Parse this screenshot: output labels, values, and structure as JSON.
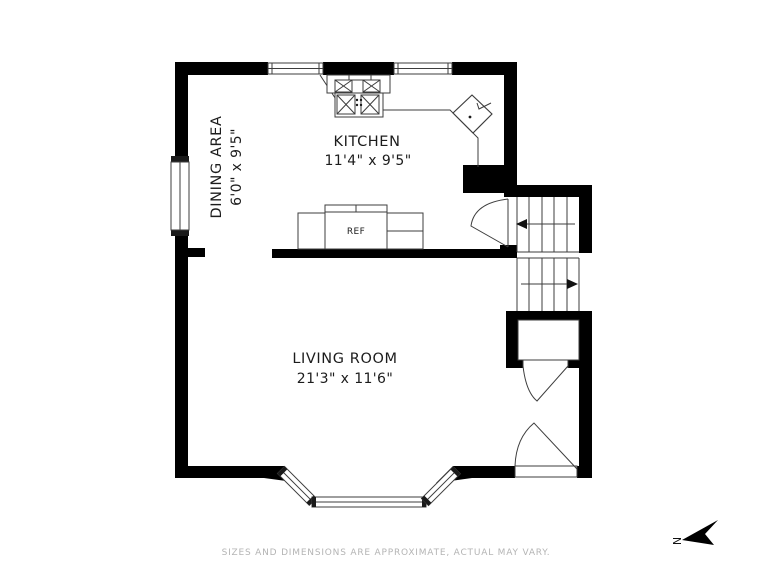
{
  "title": "Floor plan",
  "rooms": {
    "dining": {
      "name": "DINING AREA",
      "dims": "6'0\" x 9'5\""
    },
    "kitchen": {
      "name": "KITCHEN",
      "dims": "11'4\" x 9'5\""
    },
    "living": {
      "name": "LIVING ROOM",
      "dims": "21'3\" x 11'6\""
    }
  },
  "fixtures": {
    "refrigerator": "REF"
  },
  "compass": {
    "north": "N"
  },
  "footer": {
    "disclaimer": "SIZES AND DIMENSIONS ARE APPROXIMATE, ACTUAL MAY VARY."
  },
  "colors": {
    "wall": "#000000",
    "line": "#3d3d3d",
    "label": "#1c1c1c",
    "muted": "#b4b4b4",
    "background": "#ffffff"
  }
}
